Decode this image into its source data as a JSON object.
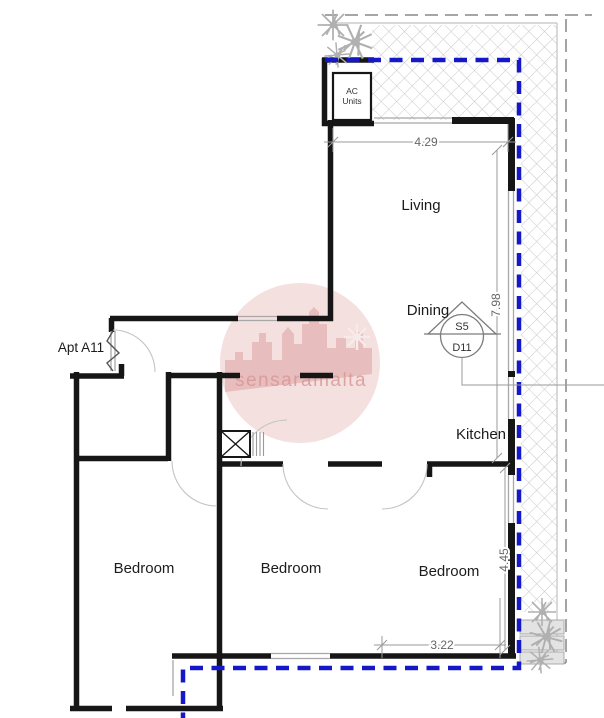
{
  "plan": {
    "apartment_label": "Apt A11",
    "ac_units": {
      "line1": "AC",
      "line2": "Units"
    },
    "rooms": {
      "living": "Living",
      "dining": "Dining",
      "kitchen": "Kitchen",
      "bedroom_left": "Bedroom",
      "bedroom_middle": "Bedroom",
      "bedroom_right": "Bedroom"
    },
    "dimensions": {
      "living_width": "4.29",
      "right_height_upper": "7.98",
      "bedroom_height": "4.45",
      "bedroom_width": "3.22"
    },
    "door_tag": {
      "top": "S5",
      "bottom": "D11"
    },
    "watermark_text": "sensaramalta",
    "colors": {
      "boundary_blue": "#1518c6",
      "wall_black": "#161616",
      "site_dash_gray": "#9a9a9a",
      "hatch_gray": "#c8c8c8",
      "dimension_gray": "#8a8a8a",
      "watermark_pink": "#ecc2c2"
    }
  }
}
